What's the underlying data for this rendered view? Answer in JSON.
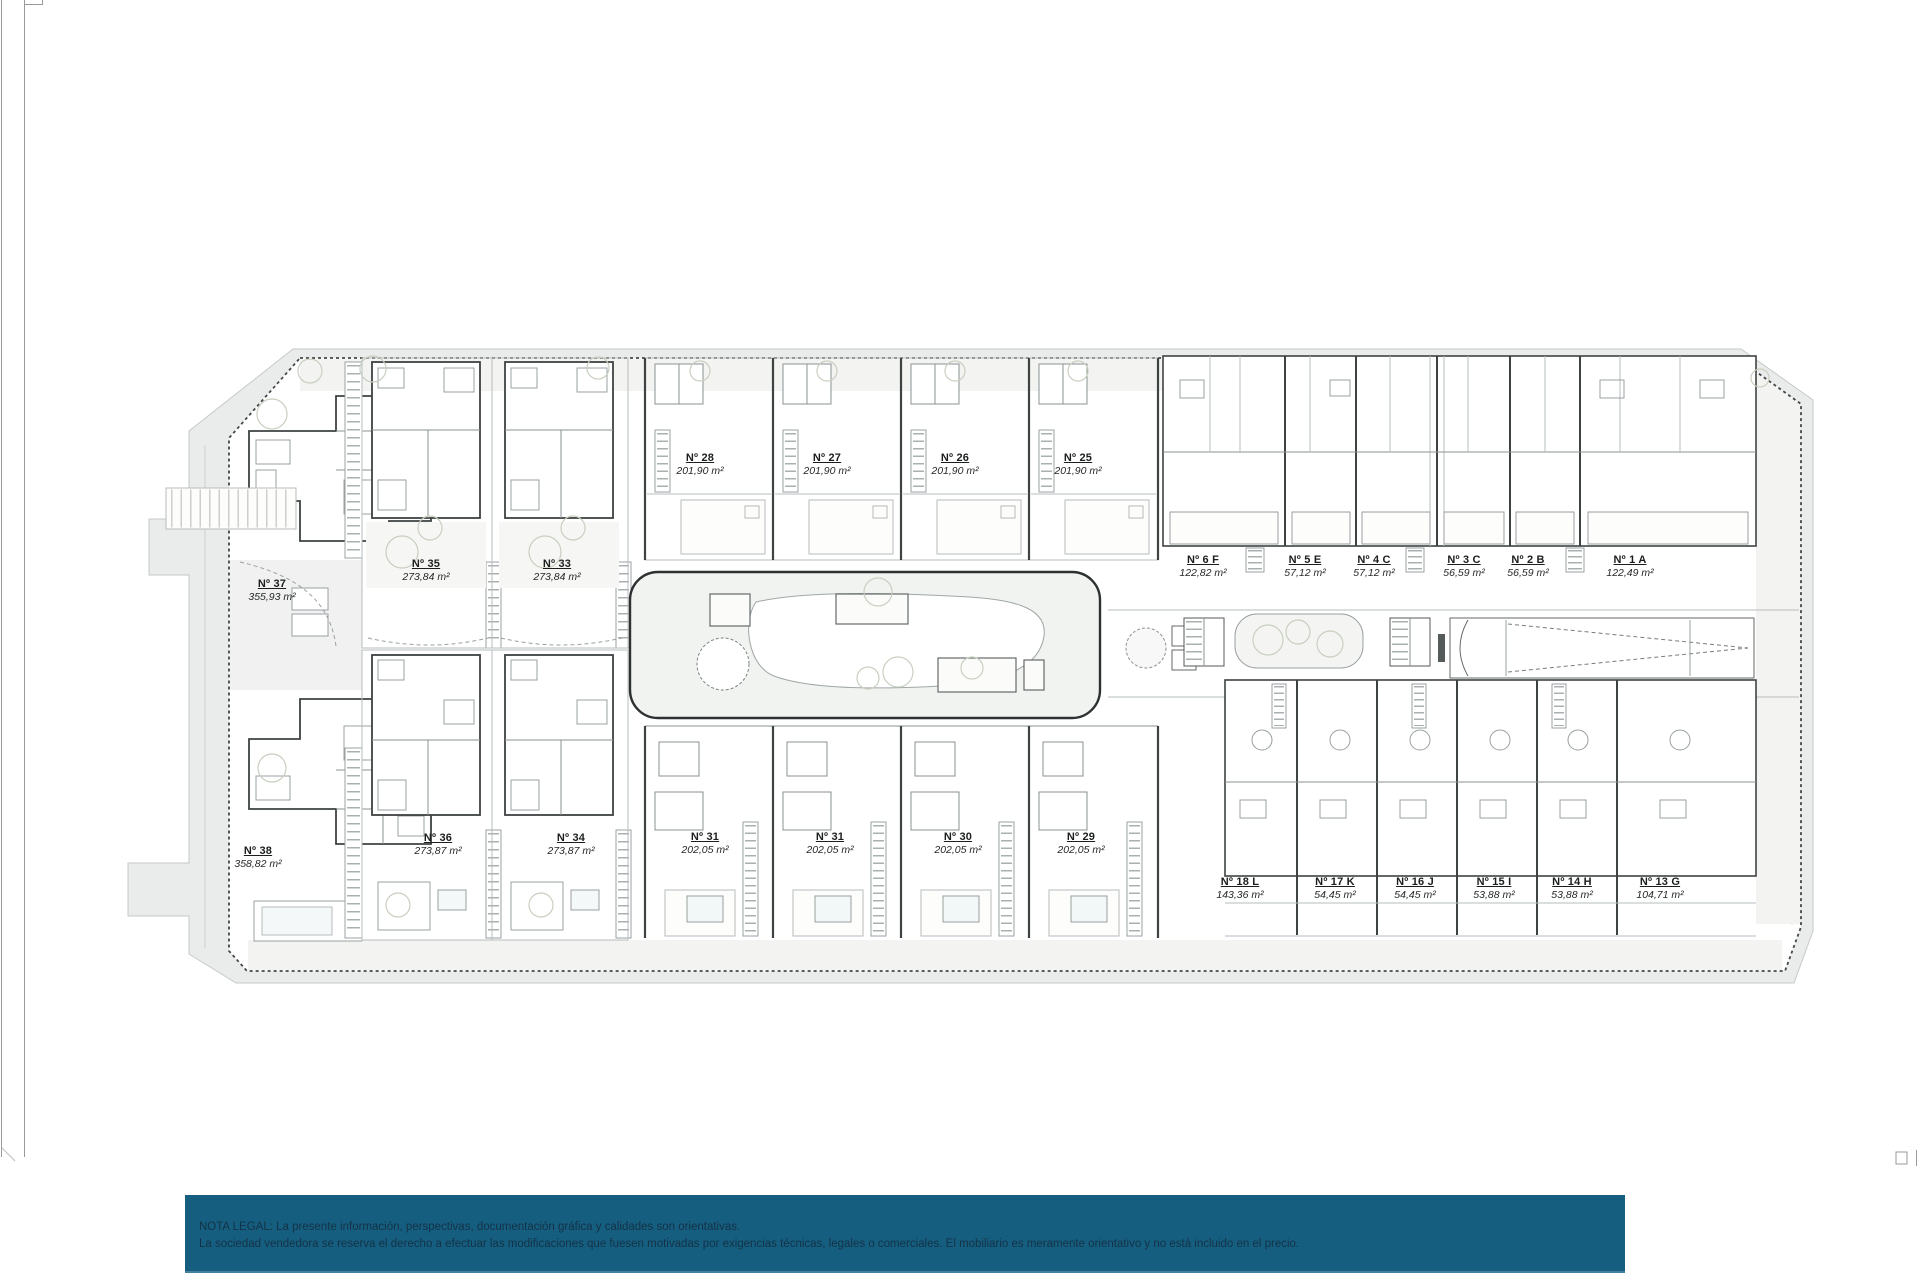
{
  "plan": {
    "units": [
      {
        "id": "Nº 37",
        "area": "355,93 m²",
        "group": "villas-left-top"
      },
      {
        "id": "Nº 38",
        "area": "358,82 m²",
        "group": "villas-left-bottom"
      },
      {
        "id": "Nº 35",
        "area": "273,84 m²",
        "group": "paired-villas-top"
      },
      {
        "id": "Nº 33",
        "area": "273,84 m²",
        "group": "paired-villas-top"
      },
      {
        "id": "Nº 36",
        "area": "273,87 m²",
        "group": "paired-villas-bottom"
      },
      {
        "id": "Nº 34",
        "area": "273,87 m²",
        "group": "paired-villas-bottom"
      },
      {
        "id": "Nº 28",
        "area": "201,90 m²",
        "group": "townhouses-top"
      },
      {
        "id": "Nº 27",
        "area": "201,90 m²",
        "group": "townhouses-top"
      },
      {
        "id": "Nº 26",
        "area": "201,90 m²",
        "group": "townhouses-top"
      },
      {
        "id": "Nº 25",
        "area": "201,90 m²",
        "group": "townhouses-top"
      },
      {
        "id": "Nº 31",
        "area": "202,05 m²",
        "group": "townhouses-bottom"
      },
      {
        "id": "Nº 31",
        "area": "202,05 m²",
        "group": "townhouses-bottom"
      },
      {
        "id": "Nº 30",
        "area": "202,05 m²",
        "group": "townhouses-bottom"
      },
      {
        "id": "Nº 29",
        "area": "202,05 m²",
        "group": "townhouses-bottom"
      },
      {
        "id": "Nº 6 F",
        "area": "122,82 m²",
        "group": "apartments-top"
      },
      {
        "id": "Nº 5 E",
        "area": "57,12 m²",
        "group": "apartments-top"
      },
      {
        "id": "Nº 4 C",
        "area": "57,12 m²",
        "group": "apartments-top"
      },
      {
        "id": "Nº 3 C",
        "area": "56,59 m²",
        "group": "apartments-top"
      },
      {
        "id": "Nº 2 B",
        "area": "56,59 m²",
        "group": "apartments-top"
      },
      {
        "id": "Nº 1 A",
        "area": "122,49 m²",
        "group": "apartments-top"
      },
      {
        "id": "Nº 18 L",
        "area": "143,36 m²",
        "group": "apartments-bottom"
      },
      {
        "id": "Nº 17 K",
        "area": "54,45 m²",
        "group": "apartments-bottom"
      },
      {
        "id": "Nº 16 J",
        "area": "54,45 m²",
        "group": "apartments-bottom"
      },
      {
        "id": "Nº 15 I",
        "area": "53,88 m²",
        "group": "apartments-bottom"
      },
      {
        "id": "Nº 14 H",
        "area": "53,88 m²",
        "group": "apartments-bottom"
      },
      {
        "id": "Nº 13 G",
        "area": "104,71 m²",
        "group": "apartments-bottom"
      }
    ]
  },
  "footer": {
    "line1": "NOTA LEGAL: La presente información, perspectivas, documentación gráfica y calidades son orientativas.",
    "line2": "La sociedad vendedora se reserva el derecho a efectuar las modificaciones que fuesen motivadas por exigencias técnicas, legales o comerciales. El mobiliario es meramente orientativo y no está incluido en el precio."
  },
  "colors": {
    "footer_background": "#155E7F",
    "footer_text": "#143247",
    "site_band": "#EAECEC",
    "boundary_line": "#454848",
    "wall_line": "#3E4242"
  }
}
